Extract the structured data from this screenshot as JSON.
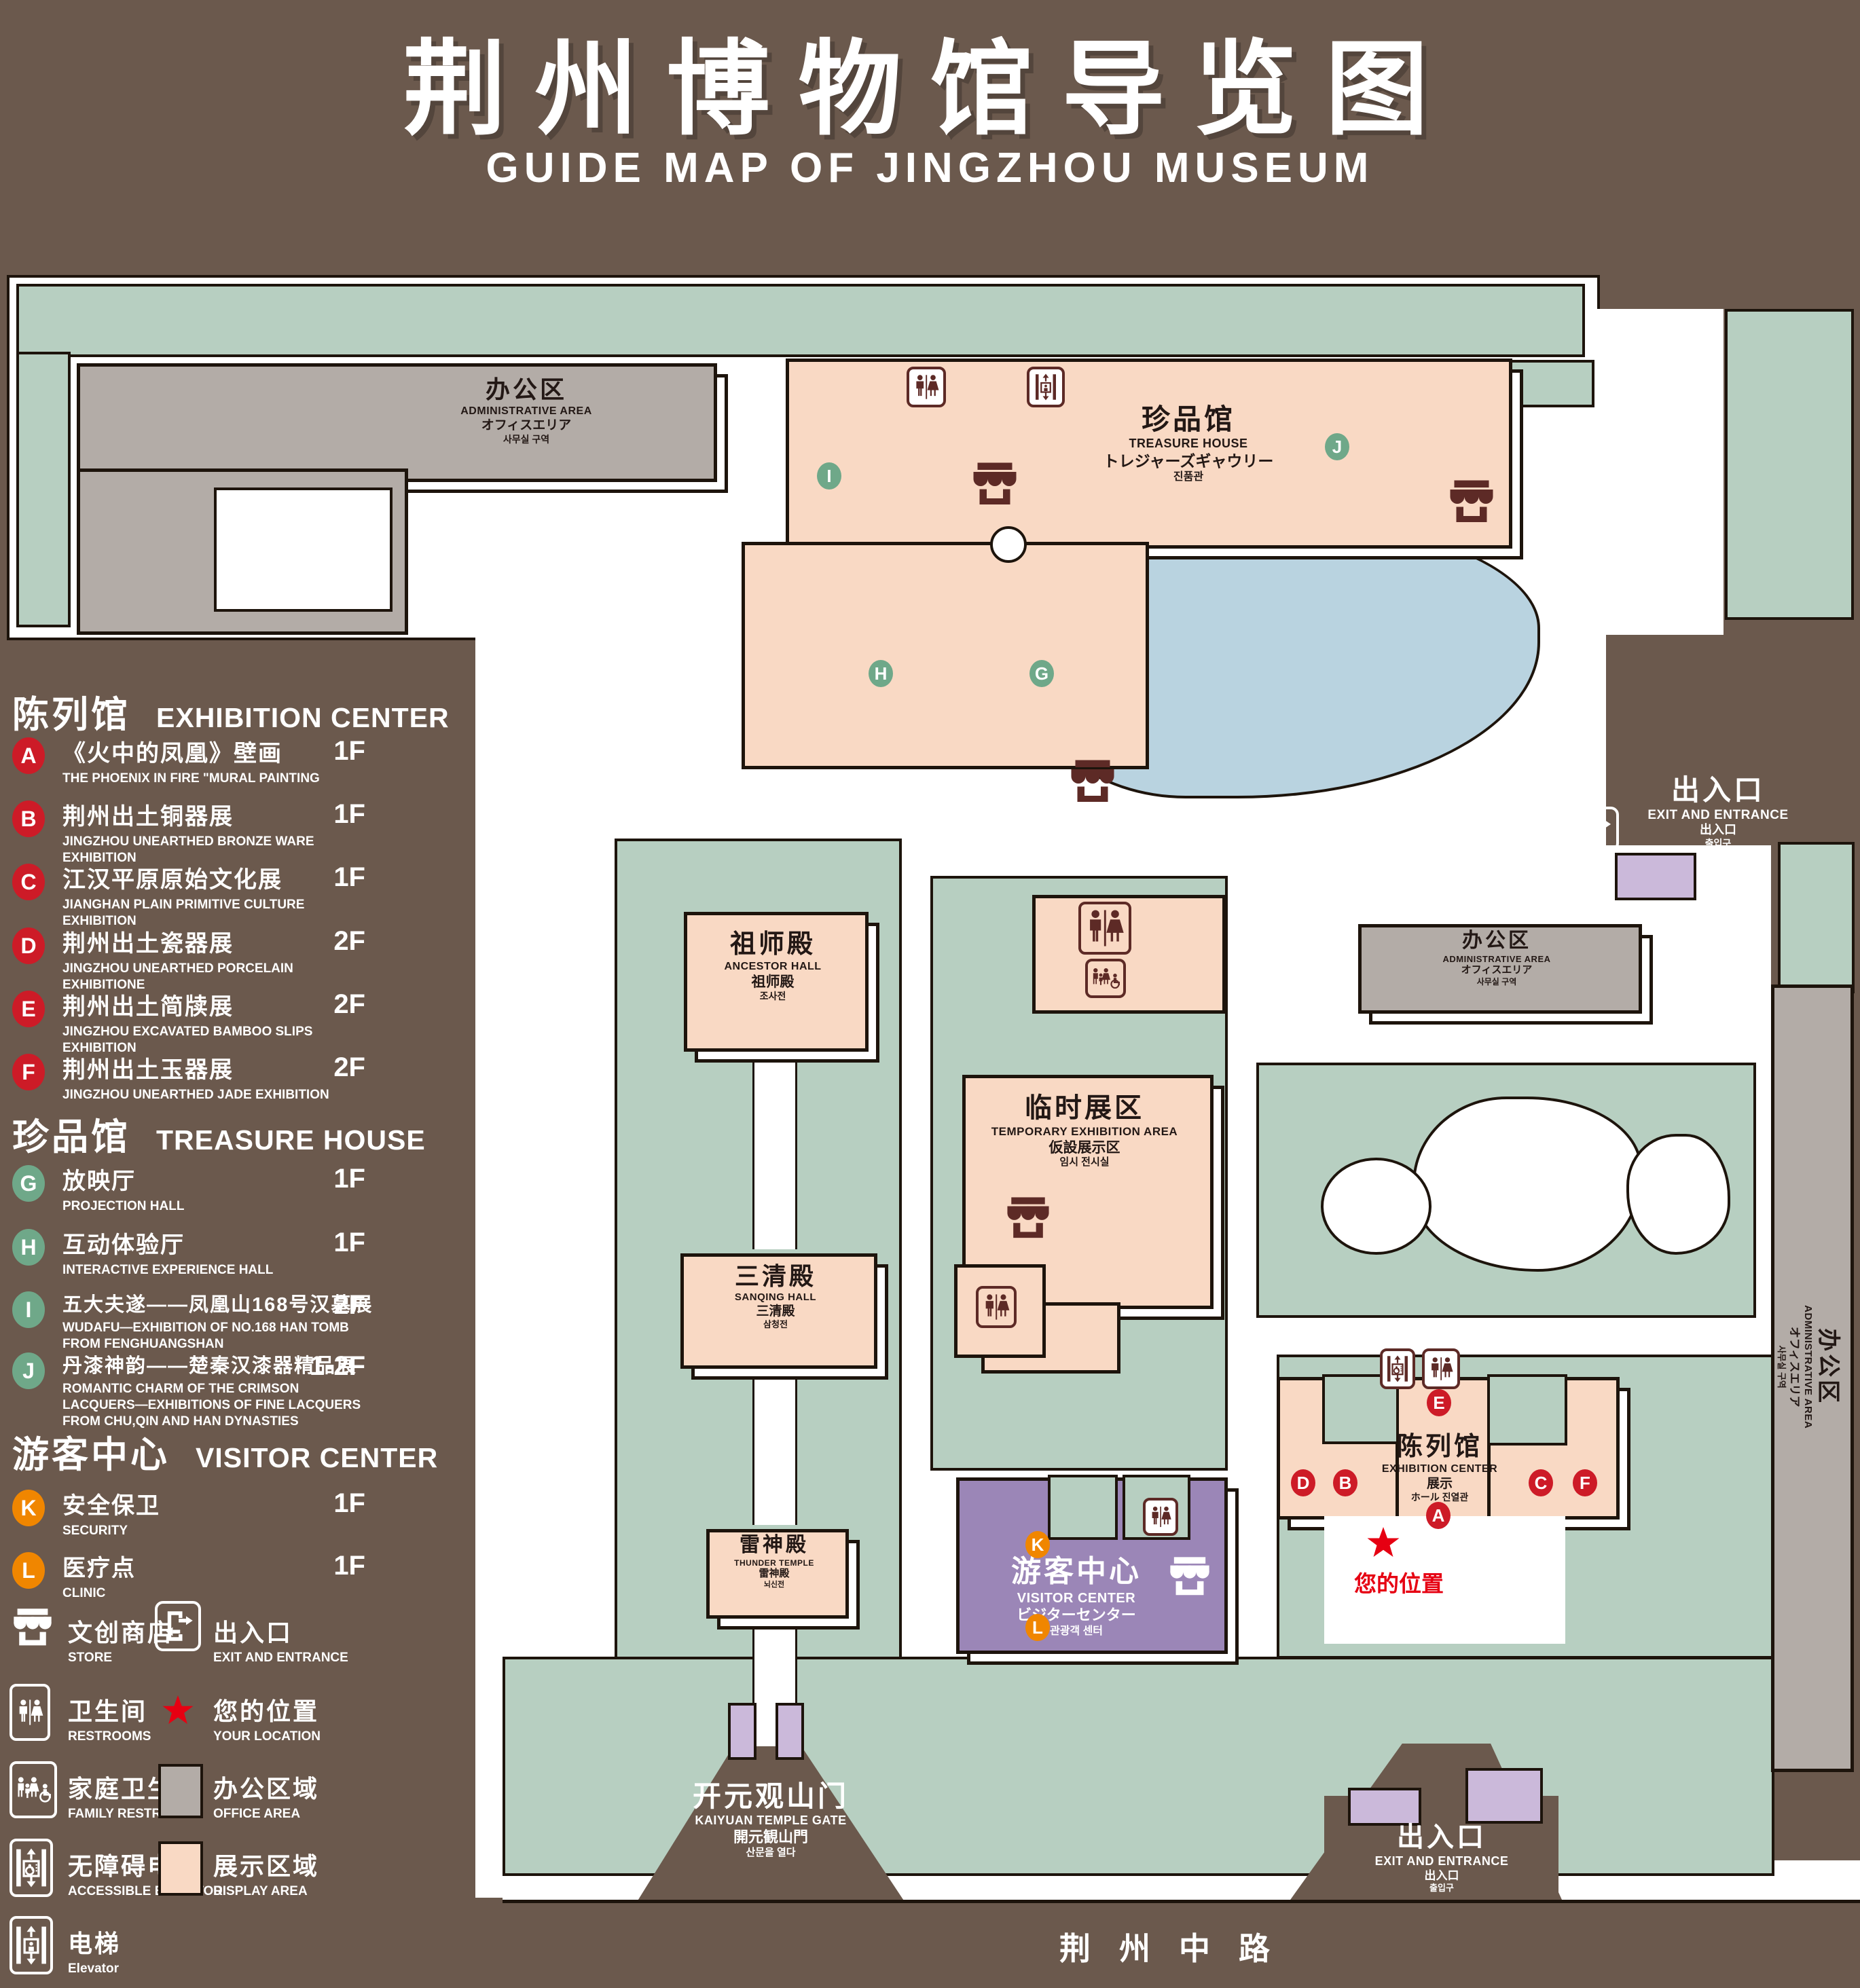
{
  "title": {
    "cn": "荆州博物馆导览图",
    "en": "GUIDE MAP OF JINGZHOU MUSEUM"
  },
  "legend": {
    "sections": [
      {
        "title_cn": "陈列馆",
        "title_en": "EXHIBITION CENTER",
        "items": [
          {
            "letter": "A",
            "cn": "《火中的凤凰》壁画",
            "en": "THE PHOENIX IN FIRE \"MURAL PAINTING",
            "floor": "1F"
          },
          {
            "letter": "B",
            "cn": "荆州出土铜器展",
            "en": "JINGZHOU UNEARTHED BRONZE WARE EXHIBITION",
            "floor": "1F"
          },
          {
            "letter": "C",
            "cn": "江汉平原原始文化展",
            "en": "JIANGHAN PLAIN PRIMITIVE CULTURE EXHIBITION",
            "floor": "1F"
          },
          {
            "letter": "D",
            "cn": "荆州出土瓷器展",
            "en": "JINGZHOU UNEARTHED PORCELAIN EXHIBITIONE",
            "floor": "2F"
          },
          {
            "letter": "E",
            "cn": "荆州出土简牍展",
            "en": "JINGZHOU EXCAVATED BAMBOO SLIPS EXHIBITION",
            "floor": "2F"
          },
          {
            "letter": "F",
            "cn": "荆州出土玉器展",
            "en": "JINGZHOU UNEARTHED JADE EXHIBITION",
            "floor": "2F"
          }
        ]
      },
      {
        "title_cn": "珍品馆",
        "title_en": "TREASURE HOUSE",
        "items": [
          {
            "letter": "G",
            "cn": "放映厅",
            "en": "PROJECTION HALL",
            "floor": "1F"
          },
          {
            "letter": "H",
            "cn": "互动体验厅",
            "en": "INTERACTIVE EXPERIENCE HALL",
            "floor": "1F"
          },
          {
            "letter": "I",
            "cn": "五大夫遂——凤凰山168号汉墓展",
            "en": "WUDAFU—EXHIBITION OF NO.168 HAN TOMB FROM FENGHUANGSHAN",
            "floor": "2F"
          },
          {
            "letter": "J",
            "cn": "丹漆神韵——楚秦汉漆器精品展",
            "en": "ROMANTIC CHARM OF THE CRIMSON LACQUERS—EXHIBITIONS OF FINE LACQUERS FROM CHU,QIN AND HAN DYNASTIES",
            "floor": "1-2F"
          }
        ]
      },
      {
        "title_cn": "游客中心",
        "title_en": "VISITOR CENTER",
        "items": [
          {
            "letter": "K",
            "cn": "安全保卫",
            "en": "SECURITY",
            "floor": "1F"
          },
          {
            "letter": "L",
            "cn": "医疗点",
            "en": "CLINIC",
            "floor": "1F"
          }
        ]
      }
    ],
    "symbols": [
      {
        "icon": "store-icon",
        "cn": "文创商店",
        "en": "STORE"
      },
      {
        "icon": "restroom-icon",
        "cn": "卫生间",
        "en": "RESTROOMS"
      },
      {
        "icon": "family-restroom-icon",
        "cn": "家庭卫生间",
        "en": "FAMILY RESTROOMS"
      },
      {
        "icon": "accessible-elevator-icon",
        "cn": "无障碍电梯",
        "en": "ACCESSIBLE ELEVATOR"
      },
      {
        "icon": "elevator-icon",
        "cn": "电梯",
        "en": "Elevator"
      },
      {
        "icon": "exit-icon",
        "cn": "出入口",
        "en": "EXIT AND ENTRANCE"
      },
      {
        "icon": "your-location-star-icon",
        "cn": "您的位置",
        "en": "YOUR LOCATION"
      },
      {
        "icon": "office-area-swatch",
        "cn": "办公区域",
        "en": "OFFICE AREA"
      },
      {
        "icon": "display-area-swatch",
        "cn": "展示区域",
        "en": "DISPLAY AREA"
      }
    ]
  },
  "map": {
    "buildings": {
      "admin_nw": {
        "cn": "办公区",
        "en": "ADMINISTRATIVE AREA",
        "jp": "オフィスエリア",
        "kr": "사무실 구역"
      },
      "treasure": {
        "cn": "珍品馆",
        "en": "TREASURE HOUSE",
        "jp": "トレジャーズギャウリー",
        "kr": "진품관"
      },
      "ancestor": {
        "cn": "祖师殿",
        "en": "ANCESTOR HALL",
        "jp": "祖师殿",
        "kr": "조사전"
      },
      "temporary": {
        "cn": "临时展区",
        "en": "TEMPORARY EXHIBITION AREA",
        "jp": "仮設展示区",
        "kr": "임시 전시실"
      },
      "sanqing": {
        "cn": "三清殿",
        "en": "SANQING HALL",
        "jp": "三清殿",
        "kr": "삼청전"
      },
      "thunder": {
        "cn": "雷神殿",
        "en": "THUNDER TEMPLE",
        "jp": "雷神殿",
        "kr": "뇌신전"
      },
      "visitor": {
        "cn": "游客中心",
        "en": "VISITOR CENTER",
        "jp": "ビジターセンター",
        "kr": "관광객 센터"
      },
      "exhibition": {
        "cn": "陈列馆",
        "en": "EXHIBITION CENTER",
        "jp": "展示",
        "kr": "ホール 진열관"
      },
      "admin_mid": {
        "cn": "办公区",
        "en": "ADMINISTRATIVE AREA",
        "jp": "オフィスエリア",
        "kr": "사무실 구역"
      },
      "admin_right": {
        "cn": "办公区",
        "en": "ADMINISTRATIVE AREA",
        "jp": "オフィスエリア",
        "kr": "사무실 구역"
      }
    },
    "exits": {
      "top_right": {
        "cn": "出入口",
        "en": "EXIT AND ENTRANCE",
        "jp": "出入口",
        "kr": "출입구"
      },
      "bottom": {
        "cn": "出入口",
        "en": "EXIT AND ENTRANCE",
        "jp": "出入口",
        "kr": "출입구"
      }
    },
    "gate": {
      "cn": "开元观山门",
      "en": "KAIYUAN TEMPLE GATE",
      "jp": "開元観山門",
      "kr": "산문을 열다"
    },
    "road": "荆州中路",
    "your_location": "您的位置",
    "markers": {
      "A": "A",
      "B": "B",
      "C": "C",
      "D": "D",
      "E": "E",
      "F": "F",
      "G": "G",
      "H": "H",
      "I": "I",
      "J": "J",
      "K": "K",
      "L": "L"
    }
  },
  "colors": {
    "background_brown": "#6b594d",
    "display_area_pink": "#f9d9c4",
    "office_area_gray": "#b3aca7",
    "courtyard_green": "#b7cfc1",
    "visitor_center_purple": "#9b86b7",
    "gate_purple": "#cbb9da",
    "pond_blue": "#b9d3e0",
    "marker_red": "#cd1b27",
    "marker_green": "#6fa889",
    "marker_orange": "#f08600",
    "icon_maroon": "#5d2a26",
    "location_red": "#e60012"
  }
}
